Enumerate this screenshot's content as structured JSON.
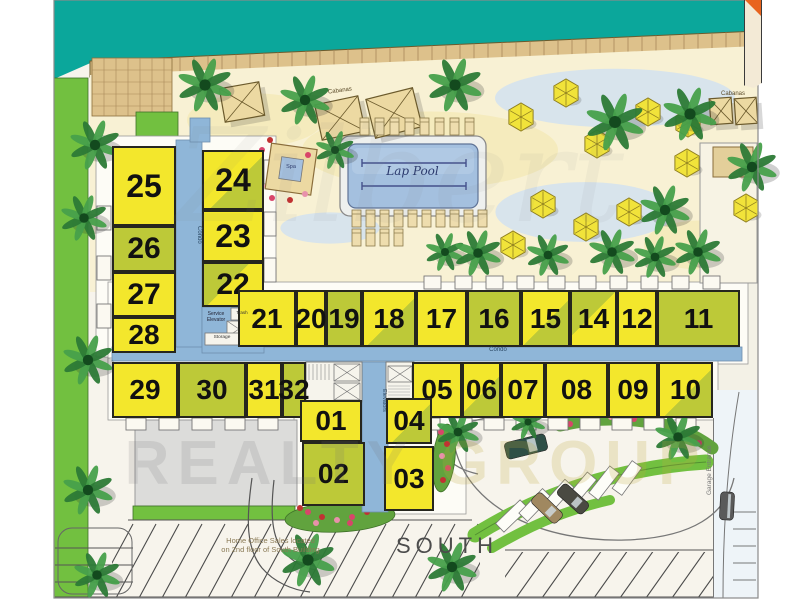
{
  "labels": {
    "lap_pool": "Lap Pool",
    "south": "SOUTH",
    "cabanas": "Cabanas",
    "garage_entrance": "Garage Entrance",
    "home_office_note_line1": "Home Office Sales located",
    "home_office_note_line2": "on 2nd floor of South Building",
    "corridor": "Condo",
    "elevators": "Elevators",
    "service_elevator": "Service Elevator",
    "trash": "Trash",
    "storage": "Storage",
    "spa": "Spa",
    "watermark_script": "Zilbert",
    "watermark_realty": "REALTY",
    "watermark_group": "GROUP"
  },
  "colors": {
    "ocean": "#0ba79b",
    "boardwalk": "#ddc18b",
    "boardwalk_line": "#a8895a",
    "beach": "#f8f1d4",
    "sand_patch": "#f4e8ae",
    "water_patch": "#cfe1f1",
    "lawn": "#72c040",
    "lawn_edge": "#3e7028",
    "unit_yellow": "#f3e72c",
    "unit_olive": "#bdc938",
    "corridor_blue": "#8fb6d8",
    "pool_water": "#a4c0df",
    "pool_lane": "#44518c",
    "deck_white": "#eef0ee",
    "garage_gray": "#dcdcda",
    "parking_line": "#4a4a4a",
    "road_line": "#777777",
    "palm_dark": "#2c7a36",
    "palm_light": "#47a04b",
    "palm_trunk": "#134a1e",
    "umbrella": "#f1e33a",
    "umbrella_edge": "#8f7f20",
    "cabana": "#ecd9a2",
    "cabana_edge": "#6b5a2c",
    "lounger": "#eeddae",
    "flower_palette": [
      "#d8456a",
      "#c03232",
      "#e891ab"
    ]
  },
  "units": [
    {
      "n": "25",
      "x": 112,
      "y": 146,
      "w": 64,
      "h": 80,
      "c": "y",
      "fs": 32
    },
    {
      "n": "26",
      "x": 112,
      "y": 226,
      "w": 64,
      "h": 46,
      "c": "o",
      "fs": 30
    },
    {
      "n": "27",
      "x": 112,
      "y": 272,
      "w": 64,
      "h": 45,
      "c": "y",
      "fs": 30
    },
    {
      "n": "28",
      "x": 112,
      "y": 317,
      "w": 64,
      "h": 36,
      "c": "y",
      "fs": 28
    },
    {
      "n": "24",
      "x": 202,
      "y": 150,
      "w": 62,
      "h": 60,
      "c": "yo",
      "fs": 32
    },
    {
      "n": "23",
      "x": 202,
      "y": 210,
      "w": 62,
      "h": 52,
      "c": "y",
      "fs": 32
    },
    {
      "n": "22",
      "x": 202,
      "y": 262,
      "w": 62,
      "h": 45,
      "c": "oy",
      "fs": 30
    },
    {
      "n": "21",
      "x": 238,
      "y": 290,
      "w": 58,
      "h": 57,
      "c": "y",
      "fs": 28
    },
    {
      "n": "20",
      "x": 296,
      "y": 290,
      "w": 30,
      "h": 57,
      "c": "y",
      "fs": 28
    },
    {
      "n": "19",
      "x": 326,
      "y": 290,
      "w": 36,
      "h": 57,
      "c": "o",
      "fs": 28
    },
    {
      "n": "18",
      "x": 362,
      "y": 290,
      "w": 54,
      "h": 57,
      "c": "yo",
      "fs": 28
    },
    {
      "n": "17",
      "x": 416,
      "y": 290,
      "w": 51,
      "h": 57,
      "c": "y",
      "fs": 28
    },
    {
      "n": "16",
      "x": 467,
      "y": 290,
      "w": 54,
      "h": 57,
      "c": "o",
      "fs": 28
    },
    {
      "n": "15",
      "x": 521,
      "y": 290,
      "w": 49,
      "h": 57,
      "c": "yo",
      "fs": 28
    },
    {
      "n": "14",
      "x": 570,
      "y": 290,
      "w": 47,
      "h": 57,
      "c": "oy",
      "fs": 28
    },
    {
      "n": "12",
      "x": 617,
      "y": 290,
      "w": 40,
      "h": 57,
      "c": "y",
      "fs": 28
    },
    {
      "n": "11",
      "x": 657,
      "y": 290,
      "w": 83,
      "h": 57,
      "c": "o",
      "fs": 28
    },
    {
      "n": "29",
      "x": 112,
      "y": 362,
      "w": 66,
      "h": 56,
      "c": "y",
      "fs": 28
    },
    {
      "n": "30",
      "x": 178,
      "y": 362,
      "w": 68,
      "h": 56,
      "c": "o",
      "fs": 28
    },
    {
      "n": "31",
      "x": 246,
      "y": 362,
      "w": 36,
      "h": 56,
      "c": "y",
      "fs": 28
    },
    {
      "n": "32",
      "x": 282,
      "y": 362,
      "w": 24,
      "h": 56,
      "c": "o",
      "fs": 28
    },
    {
      "n": "05",
      "x": 412,
      "y": 362,
      "w": 50,
      "h": 56,
      "c": "y",
      "fs": 28
    },
    {
      "n": "06",
      "x": 462,
      "y": 362,
      "w": 39,
      "h": 56,
      "c": "yo",
      "fs": 28
    },
    {
      "n": "07",
      "x": 501,
      "y": 362,
      "w": 44,
      "h": 56,
      "c": "y",
      "fs": 28
    },
    {
      "n": "08",
      "x": 545,
      "y": 362,
      "w": 63,
      "h": 56,
      "c": "y",
      "fs": 28
    },
    {
      "n": "09",
      "x": 608,
      "y": 362,
      "w": 50,
      "h": 56,
      "c": "y",
      "fs": 28
    },
    {
      "n": "10",
      "x": 658,
      "y": 362,
      "w": 55,
      "h": 56,
      "c": "yo",
      "fs": 28
    },
    {
      "n": "01",
      "x": 300,
      "y": 400,
      "w": 62,
      "h": 42,
      "c": "y",
      "fs": 28
    },
    {
      "n": "02",
      "x": 302,
      "y": 442,
      "w": 63,
      "h": 64,
      "c": "o",
      "fs": 28
    },
    {
      "n": "04",
      "x": 386,
      "y": 398,
      "w": 46,
      "h": 46,
      "c": "yo",
      "fs": 28
    },
    {
      "n": "03",
      "x": 384,
      "y": 446,
      "w": 50,
      "h": 65,
      "c": "y",
      "fs": 28
    }
  ],
  "palms": [
    [
      95,
      145,
      26
    ],
    [
      84,
      218,
      24
    ],
    [
      88,
      360,
      26
    ],
    [
      88,
      490,
      26
    ],
    [
      97,
      575,
      24
    ],
    [
      205,
      85,
      28
    ],
    [
      305,
      100,
      26
    ],
    [
      455,
      85,
      28
    ],
    [
      615,
      122,
      30
    ],
    [
      690,
      114,
      28
    ],
    [
      752,
      167,
      26
    ],
    [
      665,
      210,
      26
    ],
    [
      335,
      150,
      20
    ],
    [
      445,
      252,
      20
    ],
    [
      478,
      253,
      24
    ],
    [
      548,
      255,
      22
    ],
    [
      612,
      252,
      24
    ],
    [
      655,
      257,
      22
    ],
    [
      698,
      252,
      24
    ],
    [
      308,
      560,
      28
    ],
    [
      452,
      567,
      26
    ],
    [
      678,
      437,
      24
    ],
    [
      458,
      432,
      22
    ],
    [
      528,
      422,
      18
    ]
  ],
  "umbrellas": [
    [
      566,
      93
    ],
    [
      521,
      117
    ],
    [
      648,
      112
    ],
    [
      688,
      123
    ],
    [
      597,
      144
    ],
    [
      687,
      163
    ],
    [
      543,
      204
    ],
    [
      629,
      212
    ],
    [
      586,
      227
    ],
    [
      513,
      245
    ],
    [
      746,
      208
    ]
  ],
  "cabanas": [
    [
      222,
      85,
      40,
      34,
      -10
    ],
    [
      318,
      100,
      44,
      36,
      -12
    ],
    [
      370,
      93,
      48,
      40,
      -14
    ],
    [
      710,
      98,
      22,
      26,
      -4
    ],
    [
      735,
      98,
      22,
      26,
      -4
    ]
  ],
  "lounger_rows": [
    {
      "x": 360,
      "y": 118,
      "n": 8,
      "dx": 15
    },
    {
      "x": 352,
      "y": 210,
      "n": 10,
      "dx": 14
    },
    {
      "x": 352,
      "y": 229,
      "n": 4,
      "dx": 14
    }
  ],
  "cars": [
    [
      505,
      438,
      42,
      17,
      -14,
      "#2e4f46"
    ],
    [
      530,
      501,
      34,
      14,
      44,
      "#a08860"
    ],
    [
      556,
      492,
      34,
      14,
      42,
      "#4a4a42"
    ],
    [
      720,
      492,
      14,
      28,
      3,
      "#5a5a5a"
    ]
  ],
  "parking_slots": [
    [
      512,
      516,
      46
    ],
    [
      535,
      505,
      44
    ],
    [
      558,
      496,
      42
    ],
    [
      581,
      489,
      40
    ],
    [
      604,
      483,
      38
    ],
    [
      627,
      478,
      36
    ]
  ],
  "flower_dots_a": [
    [
      308,
      512
    ],
    [
      322,
      517
    ],
    [
      337,
      520
    ],
    [
      352,
      517
    ],
    [
      367,
      512
    ],
    [
      316,
      523
    ],
    [
      350,
      523
    ],
    [
      300,
      508
    ]
  ],
  "flower_dots_b": [
    [
      441,
      432
    ],
    [
      447,
      444
    ],
    [
      442,
      456
    ],
    [
      448,
      468
    ],
    [
      443,
      480
    ]
  ],
  "flower_dots_c": [
    [
      570,
      424
    ],
    [
      589,
      419
    ],
    [
      611,
      417
    ],
    [
      634,
      419
    ],
    [
      657,
      424
    ],
    [
      679,
      432
    ],
    [
      699,
      443
    ]
  ],
  "teeth": {
    "top_row_y": 276,
    "top_row_xs": [
      424,
      455,
      486,
      517,
      548,
      579,
      610,
      641,
      672,
      703
    ],
    "bottom_y": 418,
    "bottom_xs": [
      126,
      159,
      192,
      225,
      258,
      420,
      452,
      484,
      516,
      548,
      580,
      612,
      644,
      676
    ],
    "west_x": 97,
    "west_ys": [
      206,
      256,
      304
    ],
    "east_x": 264,
    "east_ys": [
      160,
      212,
      258
    ]
  }
}
